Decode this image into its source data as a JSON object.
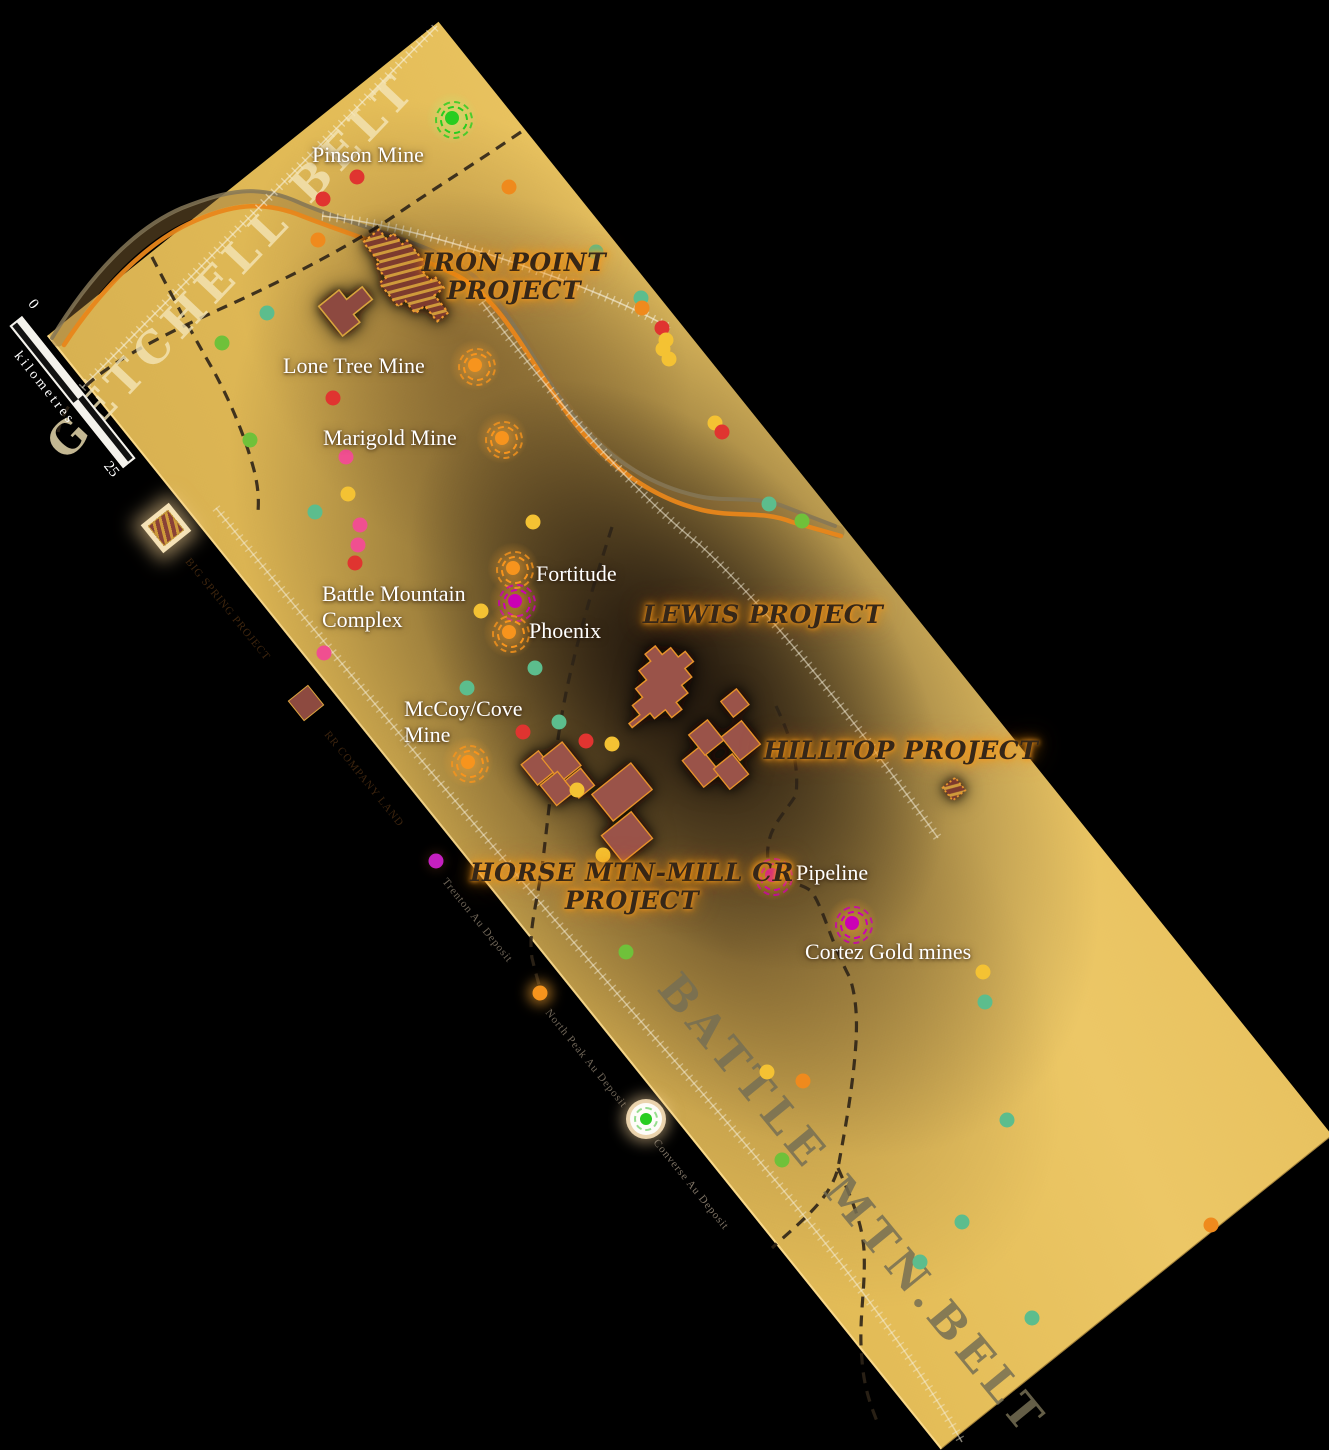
{
  "theme": {
    "background": "#000000",
    "map_gold": "#e4bd58",
    "band_dark": "#2c1e12",
    "marker_orange": "#f7941d",
    "marker_magenta": "#cb00b4",
    "marker_green": "#27cd20",
    "claim_fill": "#9a5348",
    "claim_outline": "#e8932c",
    "project_text": "#362718",
    "project_glow": "#f89a1a",
    "dot_colors": {
      "red": "#e03430",
      "orange": "#ef8a1d",
      "yellow": "#f4c233",
      "green": "#6fc13a",
      "teal": "#5cbd8d",
      "pink": "#f04f90",
      "magenta": "#c520c0"
    }
  },
  "belts": [
    {
      "id": "getchell",
      "text": "GETCHELL BELT",
      "x": 232,
      "y": 266,
      "rot": "-46.5deg",
      "color": "rgba(244,229,182,0.8)"
    },
    {
      "id": "battle-mtn",
      "text": "BATTLE MTN.BELT",
      "x": 852,
      "y": 1205,
      "rot": "50.6deg",
      "color": "rgba(118,110,84,0.85)"
    }
  ],
  "scalebar": {
    "zero": "0",
    "end": "25",
    "unit": "kilometres"
  },
  "mines": [
    {
      "name": "pinson",
      "label": "Pinson Mine",
      "lines": [
        "Pinson Mine"
      ],
      "label_x": 312,
      "label_y": 142,
      "marker": null
    },
    {
      "name": "unnamed-green",
      "label": "",
      "lines": [],
      "label_x": 0,
      "label_y": 0,
      "marker": {
        "x": 452,
        "y": 118,
        "color": "green"
      }
    },
    {
      "name": "lone-tree",
      "label": "Lone Tree Mine",
      "lines": [
        "Lone Tree Mine"
      ],
      "label_x": 283,
      "label_y": 353,
      "marker": {
        "x": 475,
        "y": 365,
        "color": "orange"
      }
    },
    {
      "name": "marigold",
      "label": "Marigold Mine",
      "lines": [
        "Marigold Mine"
      ],
      "label_x": 323,
      "label_y": 425,
      "marker": {
        "x": 502,
        "y": 438,
        "color": "orange"
      }
    },
    {
      "name": "fortitude",
      "label": "Fortitude",
      "lines": [
        "Fortitude"
      ],
      "label_x": 536,
      "label_y": 561,
      "marker": {
        "x": 513,
        "y": 568,
        "color": "orange"
      }
    },
    {
      "name": "battle-mountain-complex",
      "label": "Battle Mountain Complex",
      "lines": [
        "Battle Mountain",
        "Complex"
      ],
      "label_x": 322,
      "label_y": 581,
      "marker": {
        "x": 515,
        "y": 601,
        "color": "magenta"
      }
    },
    {
      "name": "phoenix",
      "label": "Phoenix",
      "lines": [
        "Phoenix"
      ],
      "label_x": 529,
      "label_y": 618,
      "marker": {
        "x": 509,
        "y": 632,
        "color": "orange"
      }
    },
    {
      "name": "mccoy-cove",
      "label": "McCoy/Cove Mine",
      "lines": [
        "McCoy/Cove",
        "Mine"
      ],
      "label_x": 404,
      "label_y": 696,
      "marker": {
        "x": 468,
        "y": 762,
        "color": "orange"
      }
    },
    {
      "name": "pipeline",
      "label": "Pipeline",
      "lines": [
        "Pipeline"
      ],
      "label_x": 796,
      "label_y": 860,
      "marker": {
        "x": 772,
        "y": 875,
        "color": "magenta"
      }
    },
    {
      "name": "cortez",
      "label": "Cortez Gold mines",
      "lines": [
        "Cortez Gold mines"
      ],
      "label_x": 805,
      "label_y": 939,
      "marker": {
        "x": 852,
        "y": 923,
        "color": "magenta"
      }
    }
  ],
  "projects": [
    {
      "name": "iron-point",
      "lines": [
        "IRON POINT",
        "PROJECT"
      ],
      "x": 514,
      "y": 277
    },
    {
      "name": "lewis",
      "lines": [
        "LEWIS PROJECT"
      ],
      "x": 763,
      "y": 615
    },
    {
      "name": "hilltop",
      "lines": [
        "HILLTOP PROJECT"
      ],
      "x": 901,
      "y": 751
    },
    {
      "name": "horse-mtn-mill-cr",
      "lines": [
        "HORSE MTN-MILL CR",
        "PROJECT"
      ],
      "x": 632,
      "y": 887
    }
  ],
  "edge_features": [
    {
      "name": "edge-claim-icon",
      "type": "claim-glow",
      "x": 178,
      "y": 540,
      "label": "BIG SPRING PROJECT",
      "label_x": 192,
      "label_y": 556,
      "label_color": "rgba(70,42,16,0.9)"
    },
    {
      "name": "edge-claim-square",
      "type": "claim",
      "x": 318,
      "y": 715,
      "label": "RR COMPANY LAND",
      "label_x": 331,
      "label_y": 729,
      "label_color": "rgba(70,42,16,0.85)"
    },
    {
      "name": "edge-magenta",
      "type": "dot-magenta",
      "x": 436,
      "y": 861,
      "label": "Trenton Au Deposit",
      "label_x": 449,
      "label_y": 876,
      "label_color": "rgba(140,128,110,0.8)"
    },
    {
      "name": "edge-orange",
      "type": "dot-orange",
      "x": 540,
      "y": 993,
      "label": "North Peak Au Deposit",
      "label_x": 552,
      "label_y": 1007,
      "label_color": "rgba(140,128,110,0.8)"
    },
    {
      "name": "edge-white-green",
      "type": "disc",
      "x": 646,
      "y": 1119,
      "label": "Converse Au Deposit",
      "label_x": 660,
      "label_y": 1137,
      "label_color": "rgba(150,138,120,0.85)"
    }
  ],
  "dots": [
    {
      "x": 357,
      "y": 177,
      "c": "red"
    },
    {
      "x": 323,
      "y": 199,
      "c": "red"
    },
    {
      "x": 318,
      "y": 240,
      "c": "orange"
    },
    {
      "x": 509,
      "y": 187,
      "c": "orange"
    },
    {
      "x": 596,
      "y": 252,
      "c": "teal"
    },
    {
      "x": 641,
      "y": 298,
      "c": "teal"
    },
    {
      "x": 642,
      "y": 308,
      "c": "orange"
    },
    {
      "x": 662,
      "y": 328,
      "c": "red"
    },
    {
      "x": 666,
      "y": 340,
      "c": "yellow"
    },
    {
      "x": 663,
      "y": 349,
      "c": "yellow"
    },
    {
      "x": 669,
      "y": 359,
      "c": "yellow"
    },
    {
      "x": 267,
      "y": 313,
      "c": "teal"
    },
    {
      "x": 222,
      "y": 343,
      "c": "green"
    },
    {
      "x": 250,
      "y": 440,
      "c": "green"
    },
    {
      "x": 333,
      "y": 398,
      "c": "red"
    },
    {
      "x": 346,
      "y": 457,
      "c": "pink"
    },
    {
      "x": 348,
      "y": 494,
      "c": "yellow"
    },
    {
      "x": 315,
      "y": 512,
      "c": "teal"
    },
    {
      "x": 360,
      "y": 525,
      "c": "pink"
    },
    {
      "x": 358,
      "y": 545,
      "c": "pink"
    },
    {
      "x": 355,
      "y": 563,
      "c": "red"
    },
    {
      "x": 533,
      "y": 522,
      "c": "yellow"
    },
    {
      "x": 715,
      "y": 423,
      "c": "yellow"
    },
    {
      "x": 722,
      "y": 432,
      "c": "red"
    },
    {
      "x": 769,
      "y": 504,
      "c": "teal"
    },
    {
      "x": 802,
      "y": 521,
      "c": "green"
    },
    {
      "x": 481,
      "y": 611,
      "c": "yellow"
    },
    {
      "x": 324,
      "y": 653,
      "c": "pink"
    },
    {
      "x": 535,
      "y": 668,
      "c": "teal"
    },
    {
      "x": 467,
      "y": 688,
      "c": "teal"
    },
    {
      "x": 559,
      "y": 722,
      "c": "teal"
    },
    {
      "x": 523,
      "y": 732,
      "c": "red"
    },
    {
      "x": 586,
      "y": 741,
      "c": "red"
    },
    {
      "x": 612,
      "y": 744,
      "c": "yellow"
    },
    {
      "x": 577,
      "y": 790,
      "c": "yellow"
    },
    {
      "x": 603,
      "y": 855,
      "c": "yellow"
    },
    {
      "x": 626,
      "y": 952,
      "c": "green"
    },
    {
      "x": 983,
      "y": 972,
      "c": "yellow"
    },
    {
      "x": 985,
      "y": 1002,
      "c": "teal"
    },
    {
      "x": 767,
      "y": 1072,
      "c": "yellow"
    },
    {
      "x": 803,
      "y": 1081,
      "c": "orange"
    },
    {
      "x": 782,
      "y": 1160,
      "c": "green"
    },
    {
      "x": 1007,
      "y": 1120,
      "c": "teal"
    },
    {
      "x": 962,
      "y": 1222,
      "c": "teal"
    },
    {
      "x": 920,
      "y": 1262,
      "c": "teal"
    },
    {
      "x": 1032,
      "y": 1318,
      "c": "teal"
    },
    {
      "x": 1211,
      "y": 1225,
      "c": "orange"
    }
  ]
}
